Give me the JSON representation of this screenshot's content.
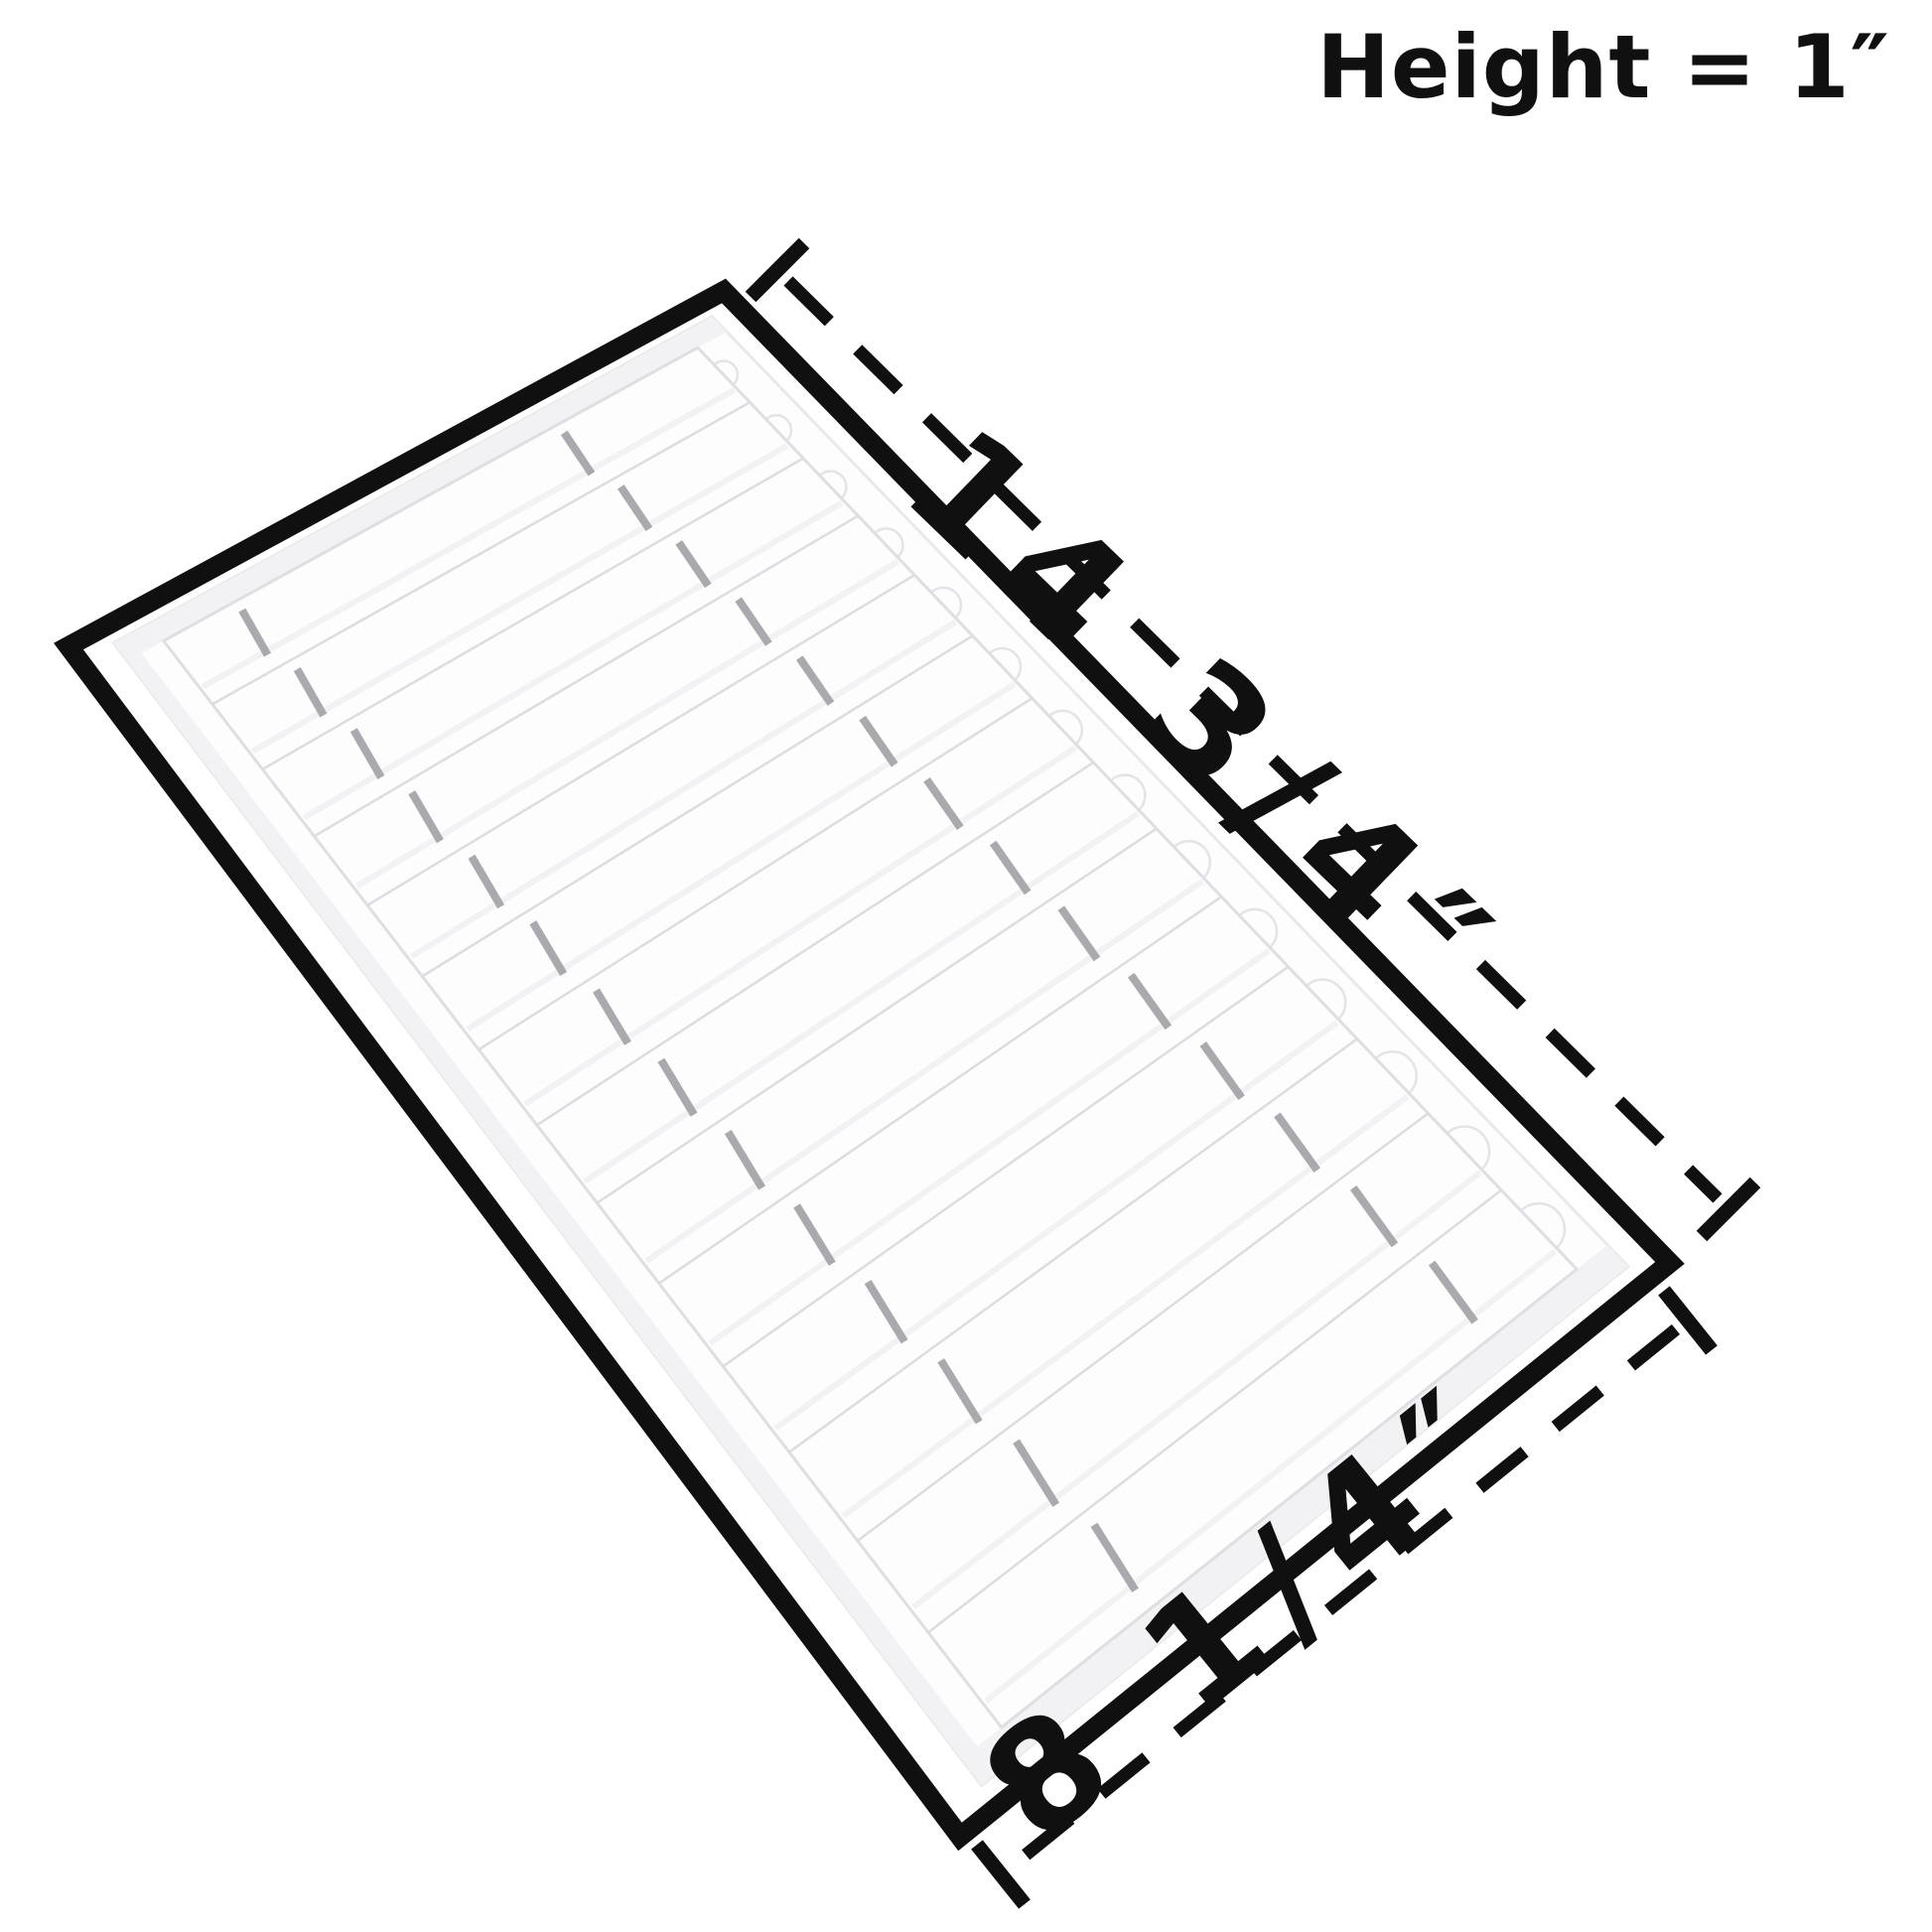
{
  "diagram": {
    "type": "product-dimension-diagram",
    "product": {
      "name": "white display tray",
      "slot_count": 14,
      "sections_per_slot": 3,
      "divider_count": 2
    },
    "annotations": {
      "length_label": "14 3/4″",
      "width_label": "8 1/4″",
      "height_label": "Height = 1″"
    },
    "colors": {
      "background": "#ffffff",
      "outline": "#101010",
      "tray_surface": "#fdfdfe",
      "groove_line": "#dcdce1",
      "floor_edge": "#dedee3",
      "divider_gray": "#a9a9ae",
      "rim_shade": "#f2f2f5"
    }
  }
}
